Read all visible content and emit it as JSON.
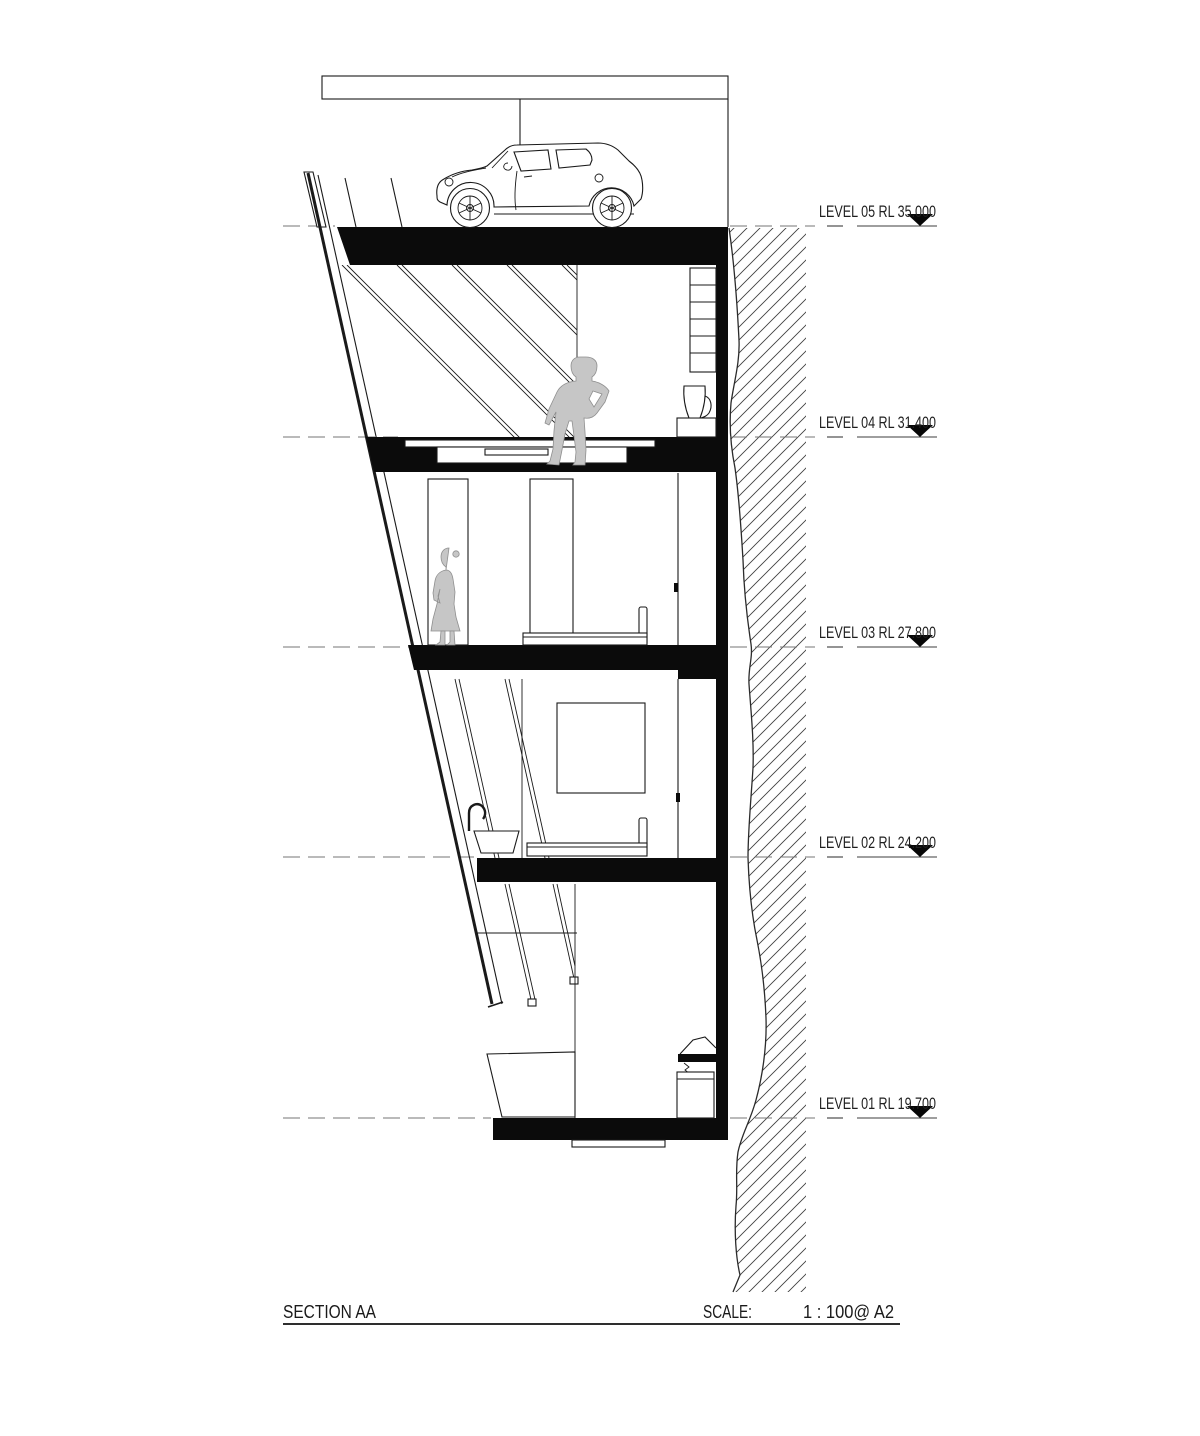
{
  "drawing": {
    "type": "architectural-section",
    "sheet_region": "building section on sloping rock face with five levels"
  },
  "levels": [
    {
      "id": "level-05",
      "label": "LEVEL 05 RL 35.000",
      "name": "LEVEL 05",
      "rl": "35.000"
    },
    {
      "id": "level-04",
      "label": "LEVEL 04 RL 31.400",
      "name": "LEVEL 04",
      "rl": "31.400"
    },
    {
      "id": "level-03",
      "label": "LEVEL 03 RL 27.800",
      "name": "LEVEL 03",
      "rl": "27.800"
    },
    {
      "id": "level-02",
      "label": "LEVEL 02 RL 24.200",
      "name": "LEVEL 02",
      "rl": "24.200"
    },
    {
      "id": "level-01",
      "label": "LEVEL 01 RL 19.700",
      "name": "LEVEL 01",
      "rl": "19.700"
    }
  ],
  "footer": {
    "title": "SECTION AA",
    "scale_label": "SCALE:",
    "scale_value": "1 : 100@ A2"
  },
  "icons": {
    "car": "car-side-view",
    "male_figure": "standing-man-silhouette",
    "female_figure": "standing-woman-silhouette",
    "level_marker": "filled-down-triangle",
    "rock": "diagonal-hatch-earth"
  },
  "colors": {
    "background": "#ffffff",
    "line": "#1a1a1a",
    "slab": "#0b0b0b",
    "figure": "#c6c6c6",
    "hatch": "#3d3d3d",
    "dash": "#767676"
  }
}
